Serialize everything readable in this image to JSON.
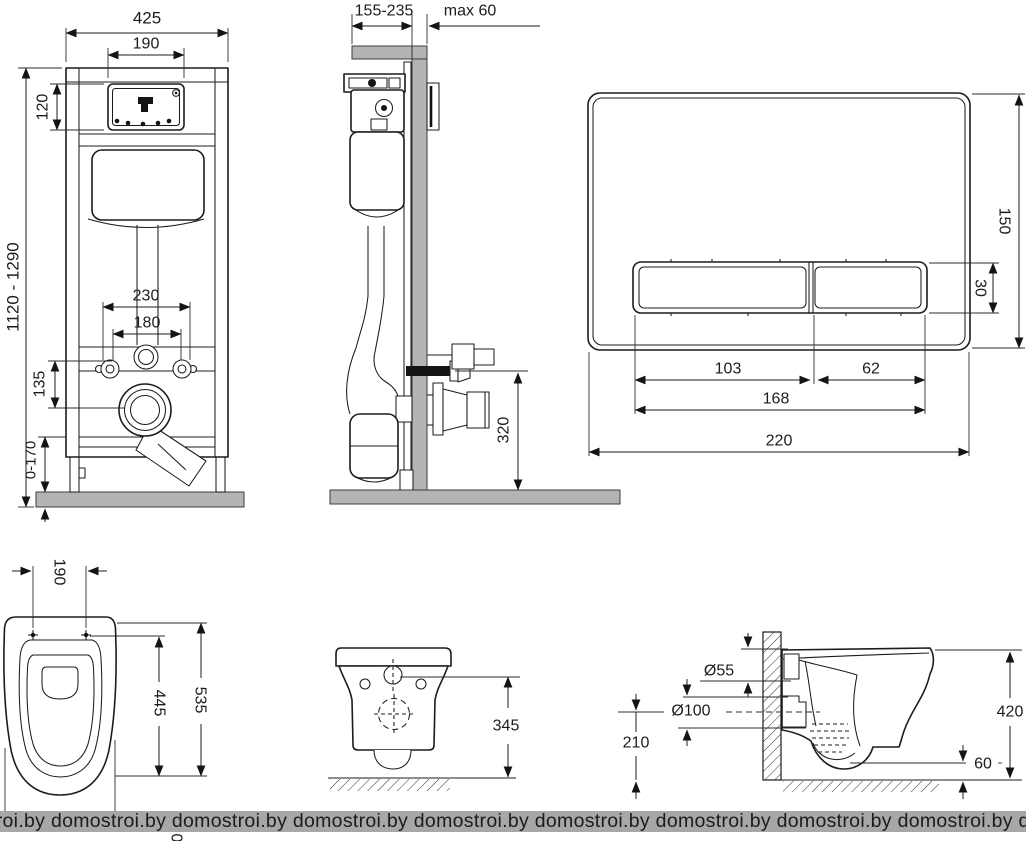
{
  "watermark": {
    "text": "domostroi.by",
    "repeat": 10
  },
  "frame_front": {
    "overall_width": "425",
    "window_width": "190",
    "window_height": "120",
    "height_range": "1120 - 1290",
    "fixing_width_outer": "230",
    "fixing_width_inner": "180",
    "fixing_to_outlet": "135",
    "leg_adjustment": "0-170"
  },
  "frame_side": {
    "depth_range": "155-235",
    "wall_thickness": "max 60",
    "outlet_height": "320"
  },
  "flush_plate": {
    "plate_height": "150",
    "button_height": "30",
    "large_button_width": "103",
    "small_button_width": "62",
    "buttons_width": "168",
    "plate_width": "220"
  },
  "bowl_top": {
    "bolt_spacing": "190",
    "bowl_depth": "445",
    "total_length": "535",
    "clipped_digit": "0"
  },
  "bowl_rear": {
    "height": "345"
  },
  "bowl_side": {
    "flush_inlet_diameter": "Ø55",
    "outlet_diameter": "Ø100",
    "outlet_height": "210",
    "total_height": "420",
    "bottom_clearance": "60"
  }
}
